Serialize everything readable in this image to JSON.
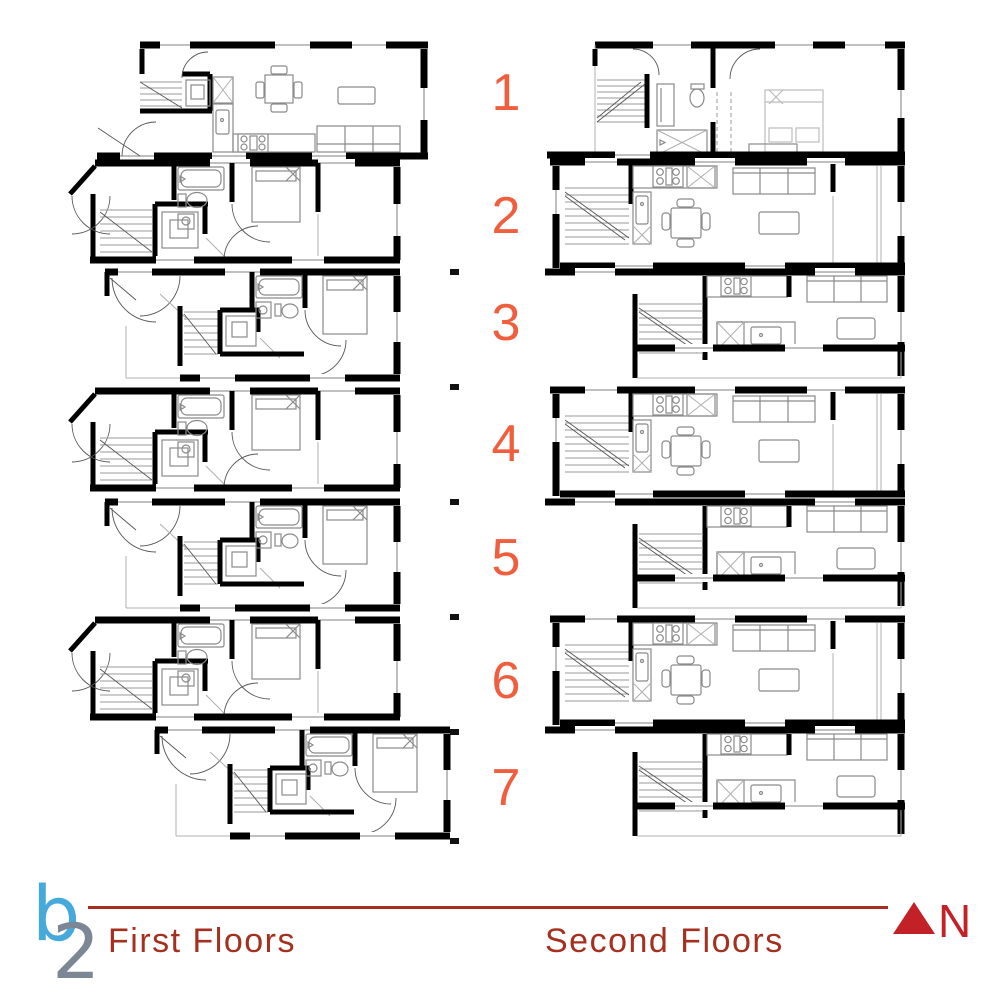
{
  "sheet": {
    "unit_numbers": [
      "1",
      "2",
      "3",
      "4",
      "5",
      "6",
      "7"
    ],
    "left_column_label": "First Floors",
    "right_column_label": "Second Floors",
    "north_label": "N",
    "logo": {
      "letter_b": "b",
      "letter_2": "2"
    },
    "colors": {
      "unit_number_orange": "#f15e3d",
      "floor_label_red": "#a5301f",
      "divider_red": "#a5301f",
      "north_arrow_red": "#c22127",
      "wall_black": "#000000",
      "fixture_gray": "#8a8a8a",
      "logo_blue": "#45aadb",
      "logo_gray": "#7c8795"
    },
    "plans": [
      {
        "unit": "1",
        "column": "first-floors",
        "contents": "entry, stairs, shower room, kitchen, dining table, sofa, coffee table"
      },
      {
        "unit": "2",
        "column": "first-floors",
        "contents": "entry, stairs, shower room, bathroom with tub and toilet, bedroom"
      },
      {
        "unit": "3",
        "column": "first-floors",
        "contents": "entry, stairs, shower room, bathroom with tub and toilet, bedroom"
      },
      {
        "unit": "4",
        "column": "first-floors",
        "contents": "entry, stairs, shower room, bathroom with tub and toilet, bedroom"
      },
      {
        "unit": "5",
        "column": "first-floors",
        "contents": "entry, stairs, shower room, bathroom with tub and toilet, bedroom"
      },
      {
        "unit": "6",
        "column": "first-floors",
        "contents": "entry, stairs, shower room, bathroom with tub and toilet, bedroom"
      },
      {
        "unit": "7",
        "column": "first-floors",
        "contents": "entry, stairs, shower room, bathroom with tub and toilet, bedroom"
      },
      {
        "unit": "1",
        "column": "second-floors",
        "contents": "stairs, bathroom with vanity, toilet and tub, closet, bedroom"
      },
      {
        "unit": "2",
        "column": "second-floors",
        "contents": "stairs, kitchen with stove and sink, dining table, sofa, coffee table"
      },
      {
        "unit": "3",
        "column": "second-floors",
        "contents": "stairs, kitchen with stove, island with sink, sofa, coffee table"
      },
      {
        "unit": "4",
        "column": "second-floors",
        "contents": "stairs, kitchen with stove and sink, dining table, sofa, coffee table"
      },
      {
        "unit": "5",
        "column": "second-floors",
        "contents": "stairs, kitchen with stove, island with sink, sofa, coffee table"
      },
      {
        "unit": "6",
        "column": "second-floors",
        "contents": "stairs, kitchen with stove and sink, dining table, sofa, coffee table"
      },
      {
        "unit": "7",
        "column": "second-floors",
        "contents": "stairs, kitchen with stove, island with sink, sofa, coffee table"
      }
    ]
  }
}
